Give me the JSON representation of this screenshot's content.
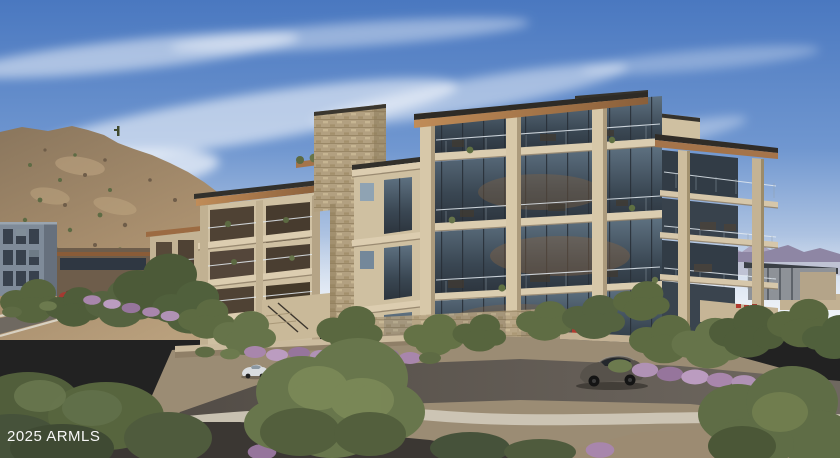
{
  "watermark": {
    "text": "2025 ARMLS",
    "color": "#ffffff"
  },
  "scene": {
    "alt": "Architectural rendering of a modern four-story luxury condominium building with glass balconies and wood roof soffits on a desert hillside; roads with cars, desert trees and purple flowering shrubs in the foreground, mountains behind"
  },
  "palette": {
    "sky_blue": "#4a78c0",
    "cloud_white": "#ffffff",
    "mountain_tan": "#a98f6e",
    "distant_mountain_purple": "#8e86a4",
    "building_beige": "#cfc0a1",
    "slab_cream": "#dbcdb0",
    "wood_soffit": "#a5744a",
    "stone_veneer": "#b2a080",
    "glass_dark": "#3a4753",
    "road_asphalt": "#57524b",
    "sidewalk": "#cfc7b7",
    "foliage_green": "#5d6b42",
    "flower_purple": "#a886ac",
    "car_red": "#a33931",
    "car_white": "#dadde0",
    "car_dark": "#57524b"
  }
}
